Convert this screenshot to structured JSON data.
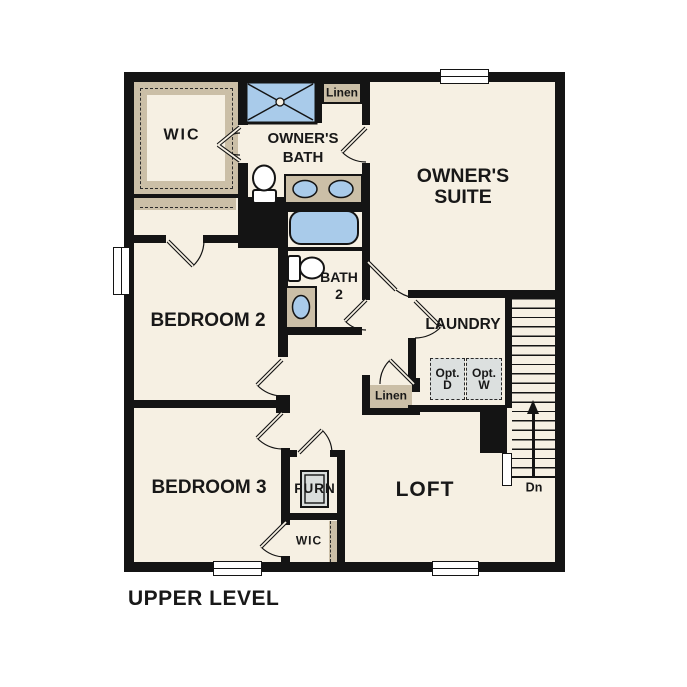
{
  "title": "UPPER LEVEL",
  "colors": {
    "wall": "#141414",
    "floor": "#F6F0E3",
    "closet_tan": "#CBBFA7",
    "fixture_blue": "#A9CBEA",
    "optional_gray": "#DCE0DF",
    "background": "#FFFFFF"
  },
  "rooms": {
    "wic_top": {
      "label": "WIC"
    },
    "owners_bath": {
      "lines": [
        "OWNER'S",
        "BATH"
      ]
    },
    "linen_top": {
      "label": "Linen"
    },
    "owners_suite": {
      "lines": [
        "OWNER'S",
        "SUITE"
      ]
    },
    "bedroom2": {
      "label": "BEDROOM 2"
    },
    "bath2": {
      "lines": [
        "BATH",
        "2"
      ]
    },
    "laundry": {
      "label": "LAUNDRY"
    },
    "linen_mid": {
      "label": "Linen"
    },
    "bedroom3": {
      "label": "BEDROOM 3"
    },
    "furnace_closet": {
      "label": "FURN"
    },
    "loft": {
      "label": "LOFT"
    },
    "wic_bottom": {
      "label": "WIC"
    }
  },
  "appliances": {
    "opt_dryer": {
      "lines": [
        "Opt.",
        "D"
      ]
    },
    "opt_washer": {
      "lines": [
        "Opt.",
        "W"
      ]
    }
  },
  "stairs": {
    "direction_label": "Dn"
  },
  "fixtures": {
    "shower": "shower-pan-icon",
    "bathtub": "bathtub-icon",
    "owners_toilet": "toilet-icon",
    "owners_vanity": "double-sink-vanity-icon",
    "bath2_toilet": "toilet-icon",
    "bath2_sink": "sink-icon",
    "furnace": "furnace-icon",
    "stair_arrow": "arrow-up-icon"
  }
}
